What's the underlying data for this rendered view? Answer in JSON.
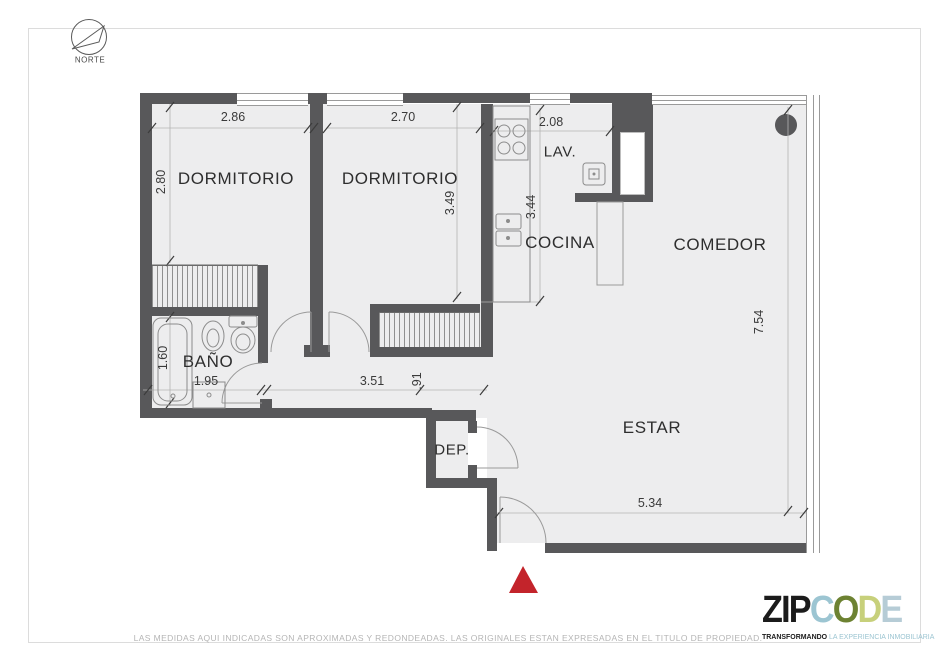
{
  "compass": {
    "label": "NORTE"
  },
  "floorplan": {
    "rooms": [
      {
        "id": "dormitorio-1",
        "label": "DORMITORIO"
      },
      {
        "id": "dormitorio-2",
        "label": "DORMITORIO"
      },
      {
        "id": "lavadero",
        "label": "LAV."
      },
      {
        "id": "cocina",
        "label": "COCINA"
      },
      {
        "id": "comedor",
        "label": "COMEDOR"
      },
      {
        "id": "banio",
        "label": "BAÑO"
      },
      {
        "id": "deposito",
        "label": "DEP."
      },
      {
        "id": "estar",
        "label": "ESTAR"
      }
    ],
    "dimensions": [
      {
        "id": "dormitorio-1-ancho",
        "label": "2.86"
      },
      {
        "id": "dormitorio-2-ancho",
        "label": "2.70"
      },
      {
        "id": "lavadero-ancho",
        "label": "2.08"
      },
      {
        "id": "dormitorio-1-alto",
        "label": "2.80"
      },
      {
        "id": "dormitorio-2-alto",
        "label": "3.49"
      },
      {
        "id": "cocina-alto",
        "label": "3.44"
      },
      {
        "id": "comedor-alto",
        "label": "7.54"
      },
      {
        "id": "banio-alto",
        "label": "1.60"
      },
      {
        "id": "banio-ancho",
        "label": "1.95"
      },
      {
        "id": "pasillo-ancho",
        "label": "3.51"
      },
      {
        "id": "pasillo-resto",
        "label": ".91"
      },
      {
        "id": "estar-ancho",
        "label": "5.34"
      }
    ],
    "colors": {
      "wall": "#58585a",
      "floor": "#ededee",
      "entrance_marker": "#c3242b"
    }
  },
  "footer": {
    "disclaimer": "LAS MEDIDAS AQUI INDICADAS SON APROXIMADAS Y REDONDEADAS. LAS ORIGINALES ESTAN EXPRESADAS EN EL TITULO DE PROPIEDAD."
  },
  "logo": {
    "part1": "ZIP",
    "letters": [
      "C",
      "O",
      "D",
      "E"
    ],
    "tagline_bold": "TRANSFORMANDO",
    "tagline_rest": " LA EXPERIENCIA INMOBILIARIA"
  }
}
